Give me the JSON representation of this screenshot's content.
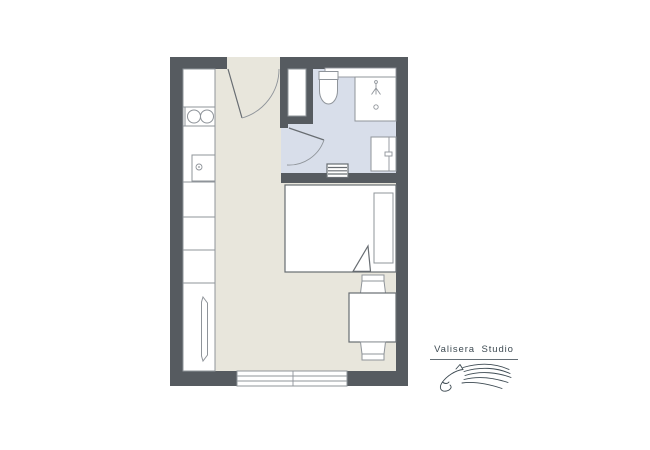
{
  "logo": {
    "name": "Valisera Studio"
  },
  "theme": {
    "bg": "#ffffff",
    "wall": "#565b60",
    "floor": "#e8e6dc",
    "bathfloor": "#d8deea",
    "line": "#8f949a",
    "linedark": "#686d72",
    "logo": "#3d4a52"
  },
  "plan": {
    "name": "studio-apartment-floor-plan",
    "rooms": [
      "entry",
      "kitchen",
      "bathroom",
      "living-room"
    ],
    "fixtures": {
      "kitchen": [
        "two-burner-stove",
        "sink-with-faucet",
        "counter-cabinets",
        "tall-cabinet"
      ],
      "bathroom": [
        "toilet",
        "shower",
        "washbasin",
        "towel-radiator",
        "bathroom-door",
        "wall-niche"
      ],
      "living": [
        "double-bed",
        "pillow",
        "folded-blanket",
        "dining-table",
        "chair",
        "chair"
      ],
      "entry": [
        "entry-door",
        "closet"
      ],
      "openings": [
        "window-bottom-wall"
      ]
    }
  }
}
